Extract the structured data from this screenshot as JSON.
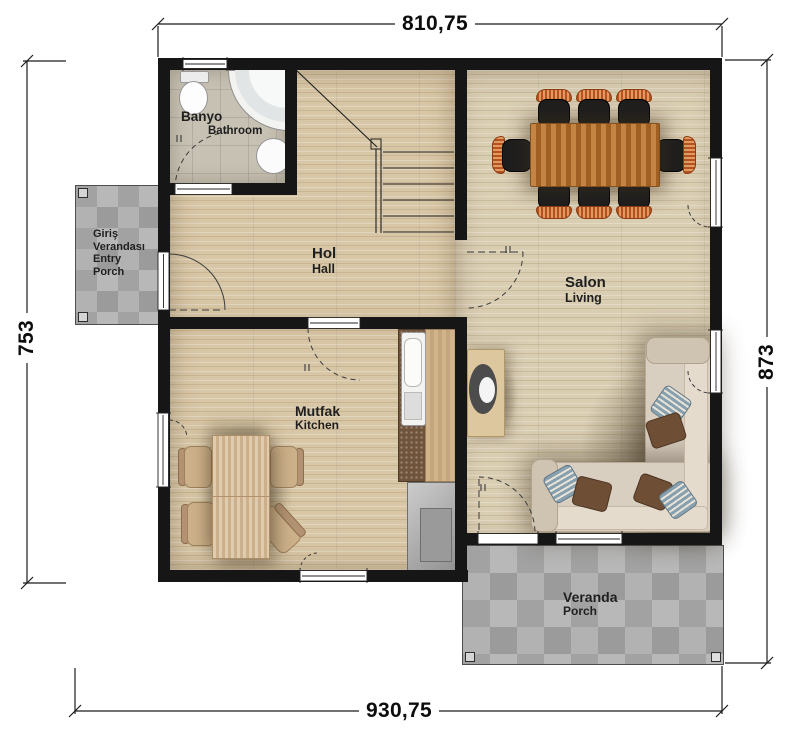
{
  "plan_title": "single-storey house floor plan",
  "dimensions": {
    "top": "810,75",
    "bottom": "930,75",
    "left": "753",
    "right": "873"
  },
  "rooms": [
    {
      "id": "bathroom",
      "label_tr": "Banyo",
      "label_en": "Bathroom"
    },
    {
      "id": "hall",
      "label_tr": "Hol",
      "label_en": "Hall"
    },
    {
      "id": "salon",
      "label_tr": "Salon",
      "label_en": "Living"
    },
    {
      "id": "kitchen",
      "label_tr": "Mutfak",
      "label_en": "Kitchen"
    },
    {
      "id": "entry_porch",
      "label_tr": "Giriş Verandası",
      "label_en": "Entry Porch"
    },
    {
      "id": "veranda",
      "label_tr": "Veranda",
      "label_en": "Porch"
    }
  ],
  "objects": [
    "dining-table-with-8-chairs",
    "l-shaped-sofa-with-pillows",
    "tv-unit",
    "kitchen-table-with-4-chairs",
    "kitchen-counter-with-sink",
    "refrigerator",
    "staircase",
    "toilet",
    "corner-bathtub",
    "washbasin"
  ],
  "colors": {
    "wall": "#161616",
    "wood_floor": "#d8c7a6",
    "salon_floor": "#d9cdb2",
    "bathroom_tile": "#c7c1b3",
    "porch_tile": "#a8a8a8",
    "dining_table": "#b06a28",
    "dining_chair_seat": "#1e1e1e",
    "dining_chair_back": "#c2622e",
    "sofa": "#d9cfc1",
    "pillow_blue": "#87a0b0",
    "pillow_brown": "#6e4e35",
    "kitchen_wood": "#d7bd98",
    "dimension_text": "#0d0d0d"
  }
}
